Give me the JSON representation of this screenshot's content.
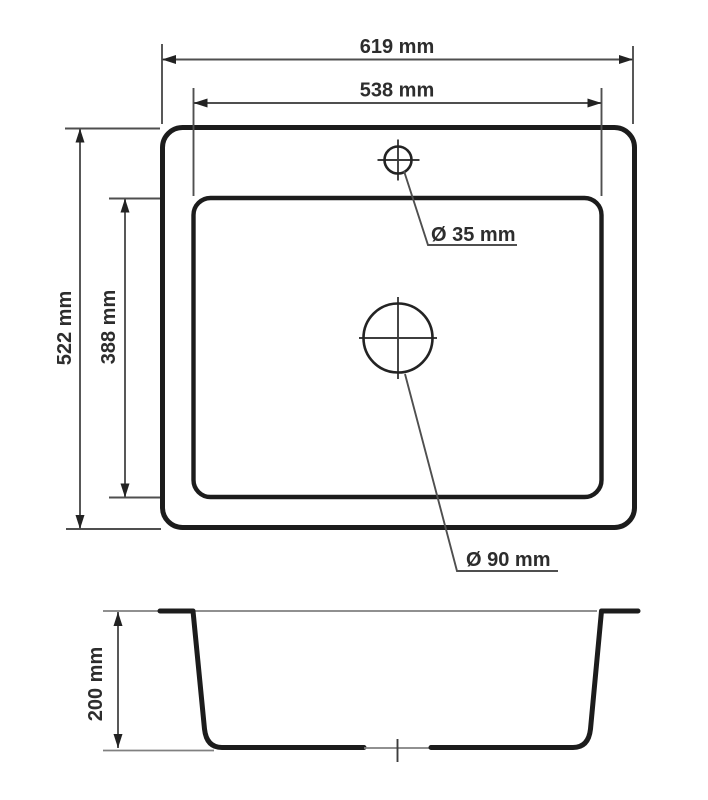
{
  "drawing": {
    "kind": "sink-technical-dimension-drawing",
    "units": "mm",
    "views": {
      "top": {
        "width_label": "619 mm",
        "bowl_width_label": "538 mm",
        "height_label": "522 mm",
        "bowl_height_label": "388 mm",
        "tap_hole_label": "Ø 35 mm",
        "drain_hole_label": "Ø 90 mm"
      },
      "section": {
        "depth_label": "200 mm"
      }
    },
    "values": {
      "outer_width_mm": 619,
      "outer_depth_mm": 522,
      "bowl_width_mm": 538,
      "bowl_depth_mm": 388,
      "bowl_height_mm": 200,
      "tap_hole_diameter_mm": 35,
      "drain_diameter_mm": 90
    },
    "colors": {
      "outline": "#1c1c1c",
      "dimension_line": "#4f4f4f",
      "extension_line": "#808080",
      "text": "#2d2d2d",
      "background": "#ffffff"
    }
  }
}
